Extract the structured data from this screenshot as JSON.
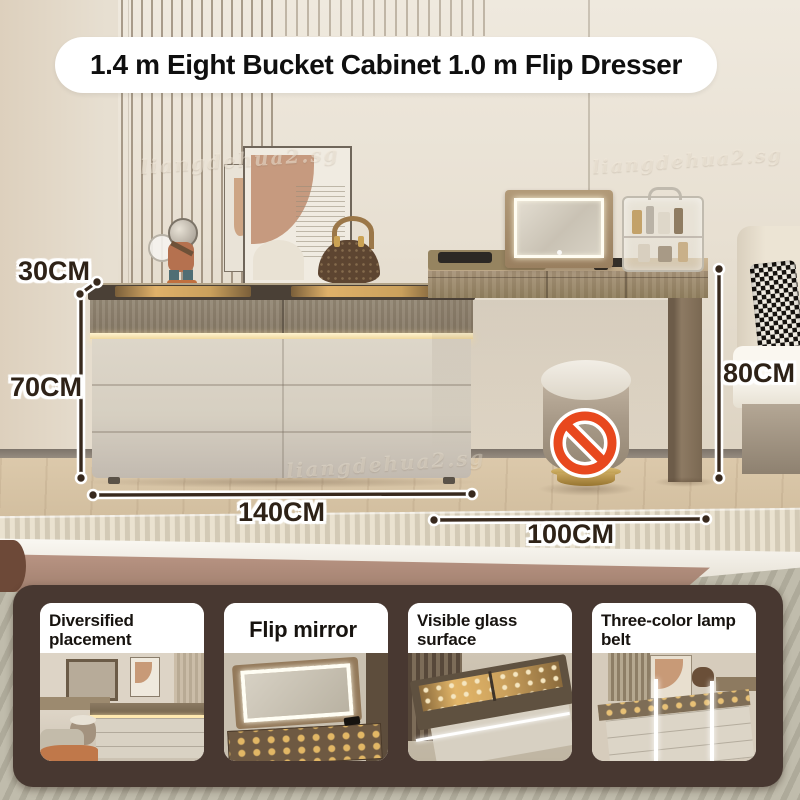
{
  "title": "1.4 m Eight Bucket Cabinet 1.0 m Flip Dresser",
  "watermark": "liangdehua2.sg",
  "measurements": {
    "cabinet_depth": "30CM",
    "cabinet_drawer_height": "70CM",
    "cabinet_width": "140CM",
    "desk_width": "100CM",
    "desk_height": "80CM"
  },
  "features": [
    {
      "label": "Diversified placement"
    },
    {
      "label": "Flip mirror"
    },
    {
      "label": "Visible glass surface"
    },
    {
      "label": "Three-color lamp belt"
    }
  ],
  "icons": {
    "no_sitting": "prohibition-circle-slash"
  },
  "colors": {
    "annotation_text": "#2e2217",
    "annotation_line": "#38291d",
    "panel_background": "#483831",
    "card_background": "#ffffff",
    "prohibition_red": "#e8481e",
    "led_strip": "#ffe9b8",
    "wall": "#e8e1d4"
  }
}
